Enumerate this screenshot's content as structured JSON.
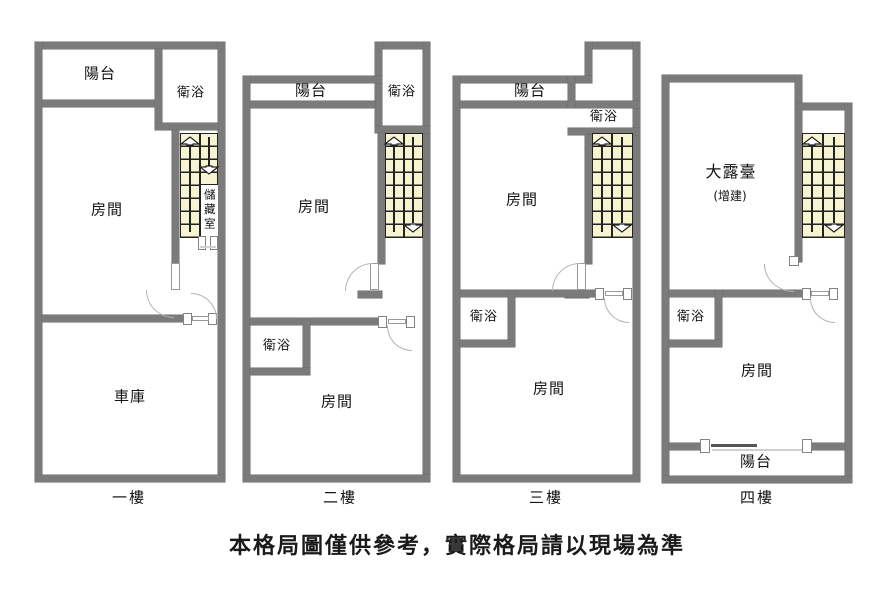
{
  "disclaimer": "本格局圖僅供參考，實際格局請以現場為準",
  "colors": {
    "wall": "#7b7b7b",
    "stair_fill": "#F7F4D2",
    "stair_line": "#222222",
    "door_arc": "#b3b3b3",
    "text": "#141414"
  },
  "floors": [
    {
      "name": "一樓",
      "rooms": {
        "balcony": "陽台",
        "bathroom_top": "衛浴",
        "room": "房間",
        "storage": "儲藏室",
        "garage": "車庫"
      }
    },
    {
      "name": "二樓",
      "rooms": {
        "balcony": "陽台",
        "bathroom_top": "衛浴",
        "room_top": "房間",
        "bathroom_mid": "衛浴",
        "room_bottom": "房間"
      }
    },
    {
      "name": "三樓",
      "rooms": {
        "balcony": "陽台",
        "bathroom_top": "衛浴",
        "room_top": "房間",
        "bathroom_mid": "衛浴",
        "room_bottom": "房間"
      }
    },
    {
      "name": "四樓",
      "rooms": {
        "terrace": "大露臺",
        "terrace_note": "(增建)",
        "bathroom_mid": "衛浴",
        "room": "房間",
        "balcony_bottom": "陽台"
      }
    }
  ]
}
